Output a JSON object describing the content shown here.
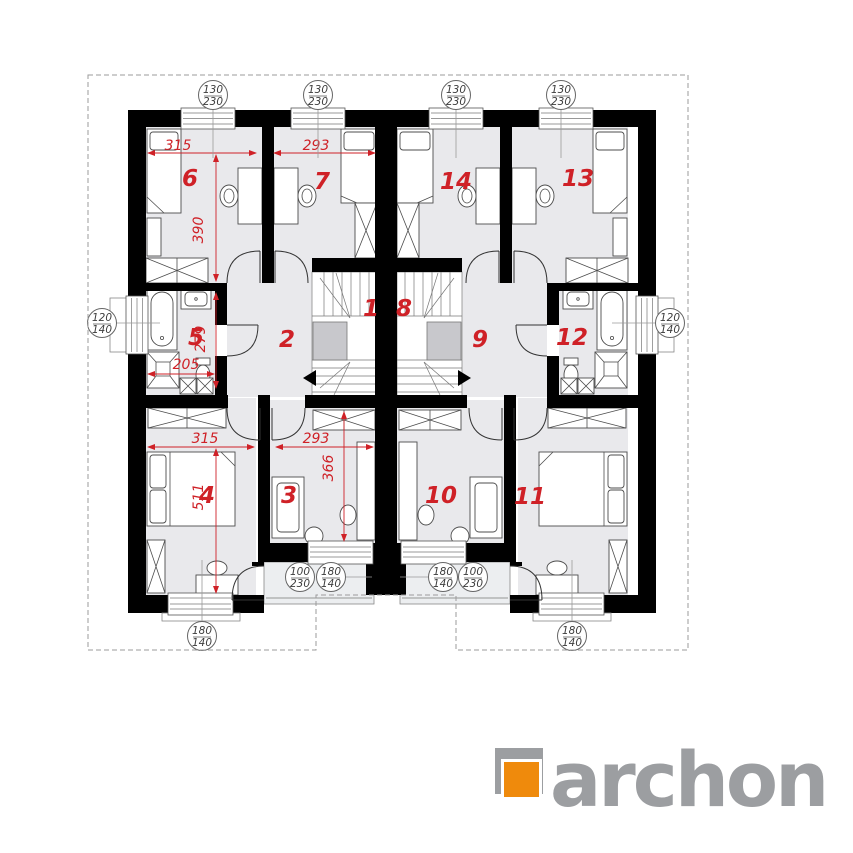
{
  "plan": {
    "colors": {
      "wall": "#000000",
      "room_fill": "#e9e9ec",
      "dimension_red": "#cf2127",
      "landing_gray": "#c8c8cc",
      "callout_text": "#3d3d3d"
    },
    "rooms": [
      {
        "label": "1"
      },
      {
        "label": "2"
      },
      {
        "label": "3"
      },
      {
        "label": "4"
      },
      {
        "label": "5"
      },
      {
        "label": "6"
      },
      {
        "label": "7"
      },
      {
        "label": "8"
      },
      {
        "label": "9"
      },
      {
        "label": "10"
      },
      {
        "label": "11"
      },
      {
        "label": "12"
      },
      {
        "label": "13"
      },
      {
        "label": "14"
      }
    ],
    "dims": {
      "room6_width": "315",
      "room7_width": "293",
      "room6_depth": "390",
      "bath5_depth": "279",
      "bath5_width": "205",
      "room4_width": "315",
      "room3_width": "293",
      "room4_depth": "511",
      "room3_depth": "366"
    },
    "callouts": [
      {
        "top": "130",
        "bottom": "230"
      },
      {
        "top": "130",
        "bottom": "230"
      },
      {
        "top": "130",
        "bottom": "230"
      },
      {
        "top": "130",
        "bottom": "230"
      },
      {
        "top": "120",
        "bottom": "140"
      },
      {
        "top": "120",
        "bottom": "140"
      },
      {
        "top": "100",
        "bottom": "230"
      },
      {
        "top": "180",
        "bottom": "140"
      },
      {
        "top": "180",
        "bottom": "140"
      },
      {
        "top": "100",
        "bottom": "230"
      },
      {
        "top": "180",
        "bottom": "140"
      },
      {
        "top": "180",
        "bottom": "140"
      }
    ]
  },
  "logo": {
    "brand": "archon",
    "orange": "#ef8a0c",
    "gray": "#9c9ea1"
  }
}
